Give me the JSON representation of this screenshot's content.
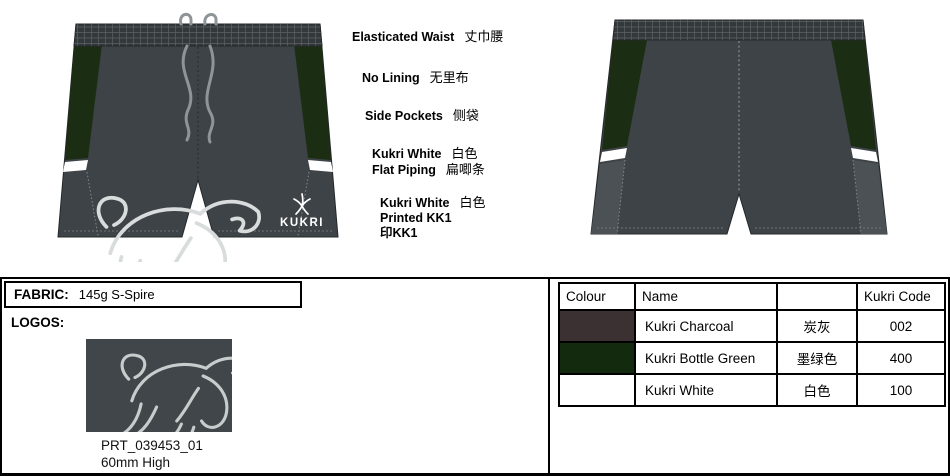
{
  "colors": {
    "charcoal": "#3e4347",
    "waistband": "#33383b",
    "bottle_green": "#1b2d12",
    "piping_white": "#ffffff",
    "panel_lite": "#4b5154",
    "cord": "#8f9497",
    "stitch": "#83888b",
    "sketch": "#d9dcdc",
    "logo_bg": "#40464a",
    "outline": "#24282a"
  },
  "brand": {
    "name": "KUKRI"
  },
  "annotations": [
    {
      "en": "Elasticated Waist",
      "zh": "丈巾腰"
    },
    {
      "en": "No Lining",
      "zh": "无里布"
    },
    {
      "en": "Side Pockets",
      "zh": "侧袋"
    },
    {
      "l1en": "Kukri White",
      "l1zh": "白色",
      "l2en": "Flat Piping",
      "l2zh": "扁唧条"
    },
    {
      "l1en": "Kukri White",
      "l1zh": "白色",
      "l2": "Printed KK1",
      "l3": "印KK1"
    }
  ],
  "fabric": {
    "label": "FABRIC:",
    "value": "145g S-Spire"
  },
  "logos": {
    "label": "LOGOS:",
    "print_code": "PRT_039453_01",
    "print_height": "60mm High"
  },
  "color_table": {
    "headers": [
      "Colour",
      "Name",
      "",
      "Kukri Code"
    ],
    "rows": [
      {
        "name": "Kukri Charcoal",
        "zh": "炭灰",
        "code": "002",
        "swatch": "#3b3133"
      },
      {
        "name": "Kukri Bottle Green",
        "zh": "墨绿色",
        "code": "400",
        "swatch": "#142a0e"
      },
      {
        "name": "Kukri White",
        "zh": "白色",
        "code": "100",
        "swatch": "#ffffff"
      }
    ]
  }
}
